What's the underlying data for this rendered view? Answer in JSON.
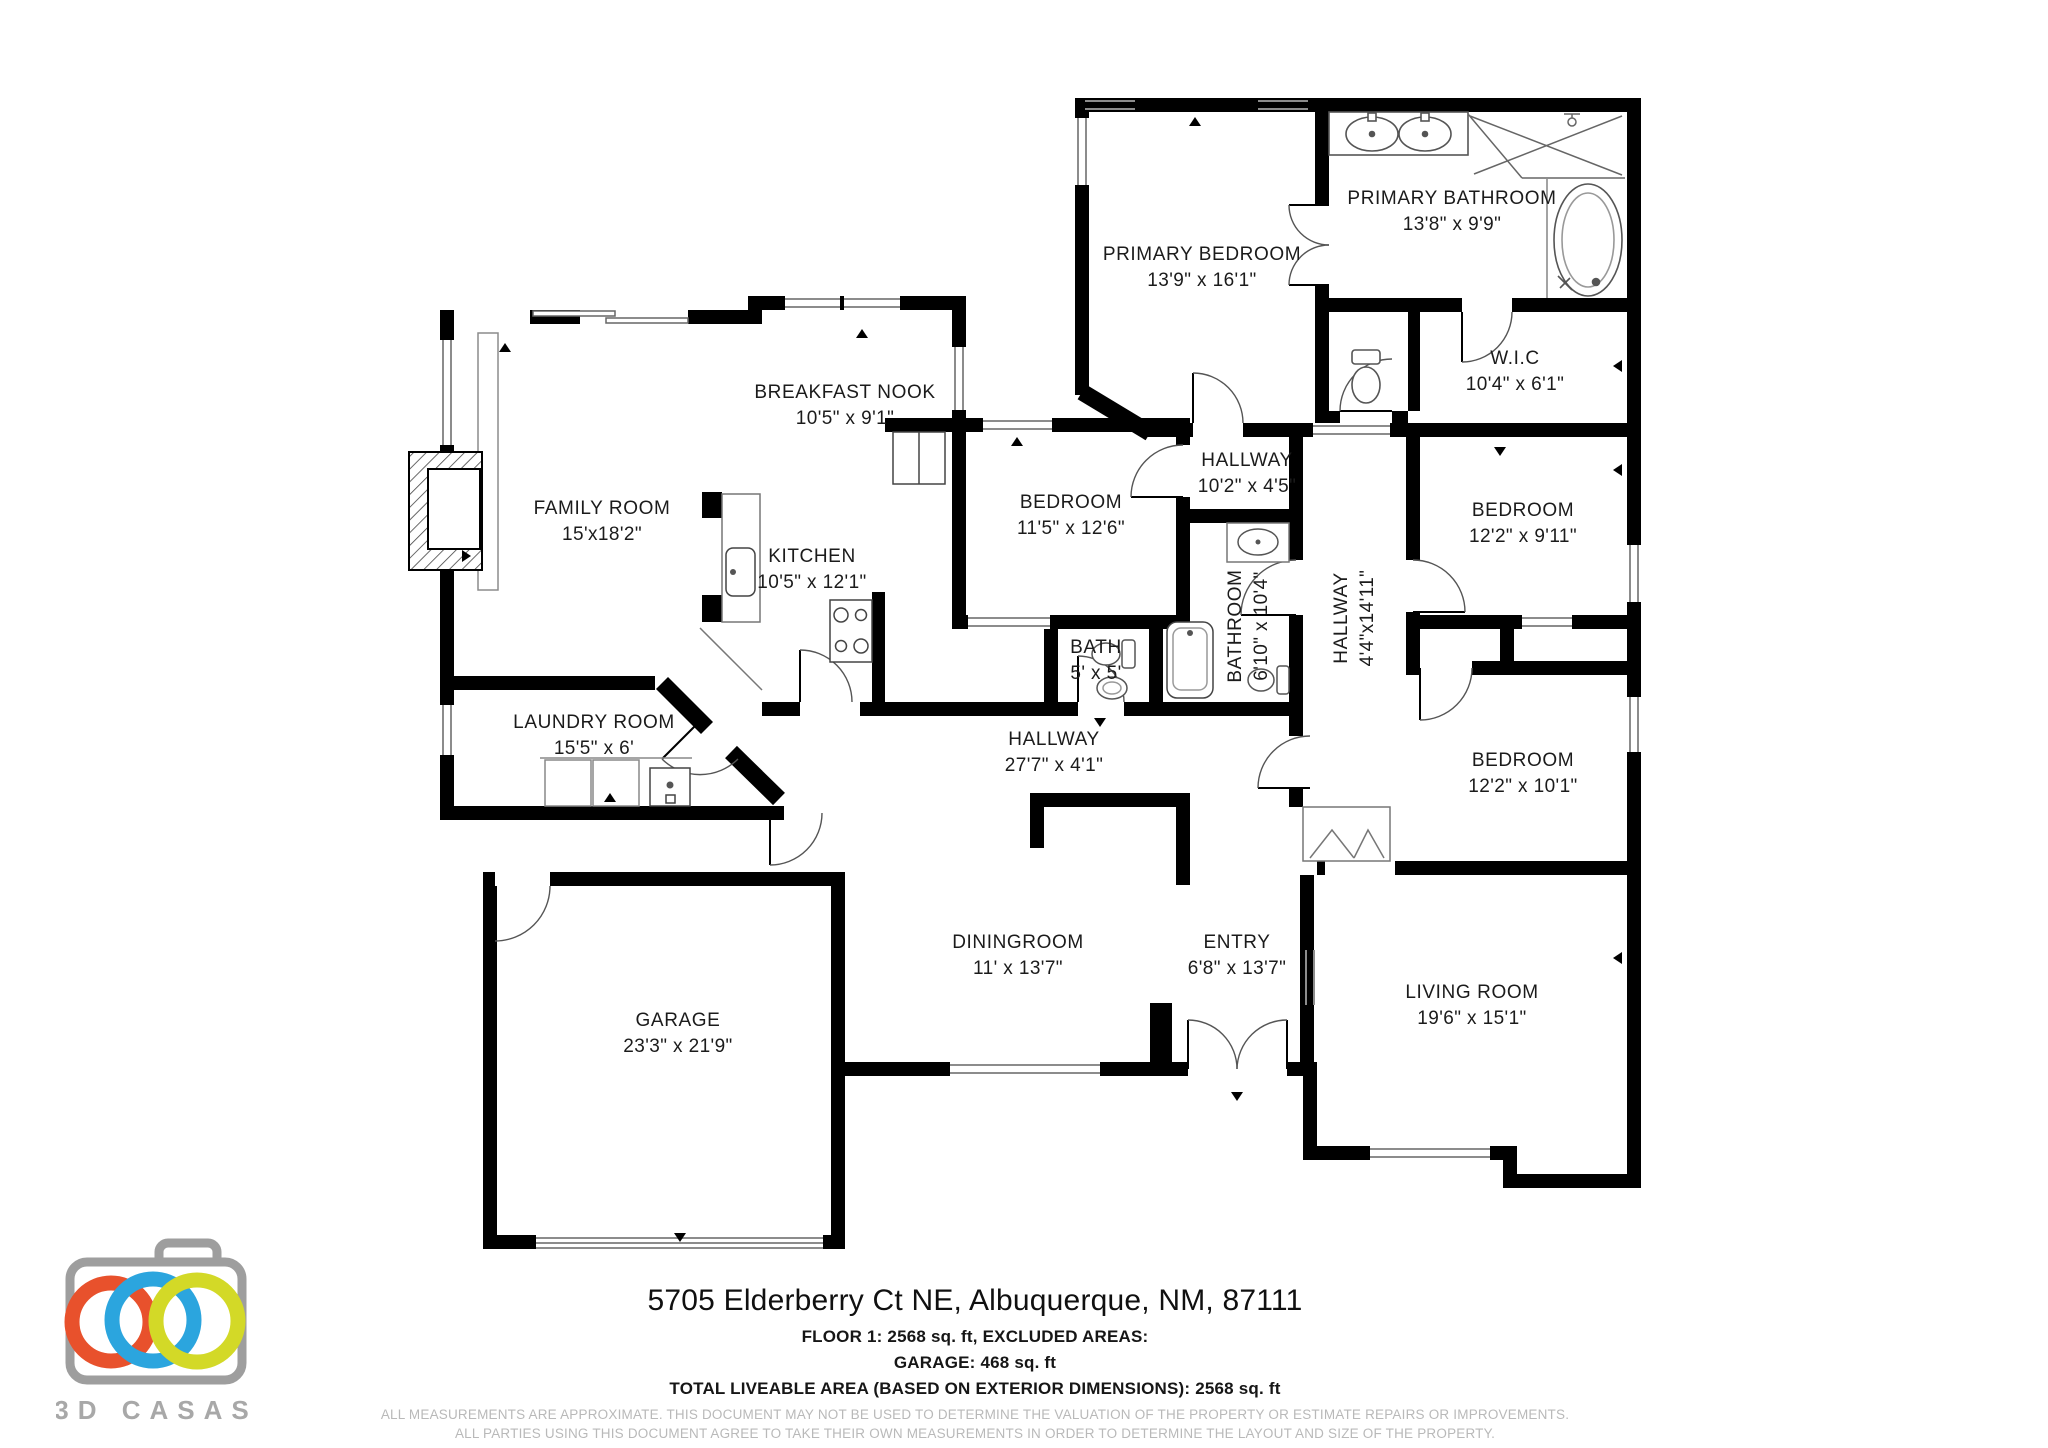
{
  "title": "Floor plan - 5705 Elderberry Ct NE",
  "rooms": [
    {
      "id": "primary-bedroom",
      "name": "PRIMARY BEDROOM",
      "dims": "13'9\" x 16'1\"",
      "x": 1202,
      "y": 268
    },
    {
      "id": "primary-bathroom",
      "name": "PRIMARY BATHROOM",
      "dims": "13'8\" x 9'9\"",
      "x": 1452,
      "y": 212
    },
    {
      "id": "wic",
      "name": "W.I.C",
      "dims": "10'4\" x 6'1\"",
      "x": 1515,
      "y": 372
    },
    {
      "id": "breakfast-nook",
      "name": "BREAKFAST NOOK",
      "dims": "10'5\" x 9'1\"",
      "x": 845,
      "y": 406
    },
    {
      "id": "family-room",
      "name": "FAMILY ROOM",
      "dims": "15'x18'2\"",
      "x": 602,
      "y": 522
    },
    {
      "id": "kitchen",
      "name": "KITCHEN",
      "dims": "10'5\" x 12'1\"",
      "x": 812,
      "y": 570
    },
    {
      "id": "bedroom-mid",
      "name": "BEDROOM",
      "dims": "11'5\" x 12'6\"",
      "x": 1071,
      "y": 516
    },
    {
      "id": "hallway-upper",
      "name": "HALLWAY",
      "dims": "10'2\" x 4'5\"",
      "x": 1247,
      "y": 474
    },
    {
      "id": "bedroom-ne",
      "name": "BEDROOM",
      "dims": "12'2\" x 9'11\"",
      "x": 1523,
      "y": 524
    },
    {
      "id": "bath",
      "name": "BATH",
      "dims": "5' x 5'",
      "x": 1096,
      "y": 661
    },
    {
      "id": "bathroom",
      "name": "BATHROOM",
      "dims": "6'10\" x 10'4\"",
      "x": 1249,
      "y": 626,
      "rot": 1
    },
    {
      "id": "hallway-tall",
      "name": "HALLWAY",
      "dims": "4'4\"x14'11\"",
      "x": 1355,
      "y": 618,
      "rot": 1
    },
    {
      "id": "bedroom-se",
      "name": "BEDROOM",
      "dims": "12'2\" x 10'1\"",
      "x": 1523,
      "y": 774
    },
    {
      "id": "laundry-room",
      "name": "LAUNDRY ROOM",
      "dims": "15'5\" x 6'",
      "x": 594,
      "y": 736
    },
    {
      "id": "hallway-main",
      "name": "HALLWAY",
      "dims": "27'7\" x 4'1\"",
      "x": 1054,
      "y": 753
    },
    {
      "id": "diningroom",
      "name": "DININGROOM",
      "dims": "11' x 13'7\"",
      "x": 1018,
      "y": 956
    },
    {
      "id": "entry",
      "name": "ENTRY",
      "dims": "6'8\" x 13'7\"",
      "x": 1237,
      "y": 956
    },
    {
      "id": "garage",
      "name": "GARAGE",
      "dims": "23'3\" x 21'9\"",
      "x": 678,
      "y": 1034
    },
    {
      "id": "living-room",
      "name": "LIVING ROOM",
      "dims": "19'6\" x 15'1\"",
      "x": 1472,
      "y": 1006
    }
  ],
  "footer": {
    "address": "5705 Elderberry Ct NE, Albuquerque, NM, 87111",
    "floor_line": "FLOOR 1: 2568 sq. ft, EXCLUDED AREAS:",
    "garage_line": "GARAGE: 468 sq. ft",
    "total_line": "TOTAL LIVEABLE AREA (BASED ON EXTERIOR DIMENSIONS): 2568 sq. ft",
    "disclaimer1": "ALL MEASUREMENTS ARE APPROXIMATE. THIS DOCUMENT MAY NOT BE USED TO DETERMINE THE VALUATION OF THE PROPERTY OR ESTIMATE REPAIRS OR IMPROVEMENTS.",
    "disclaimer2": "ALL PARTIES USING THIS DOCUMENT AGREE TO TAKE THEIR OWN MEASUREMENTS IN ORDER TO DETERMINE THE LAYOUT AND SIZE OF THE PROPERTY."
  },
  "logo": {
    "brand": "3D CASAS",
    "camera_gray": "#9e9e9e",
    "text_gray": "#a8a8a8",
    "ring_orange": "#e8512c",
    "ring_blue": "#2ba5de",
    "ring_green": "#d3d927"
  },
  "colors": {
    "walls": "#000000",
    "fixtures": "#3d3d3d",
    "light_lines": "#8c8c8c",
    "label": "#1b1b1b"
  }
}
